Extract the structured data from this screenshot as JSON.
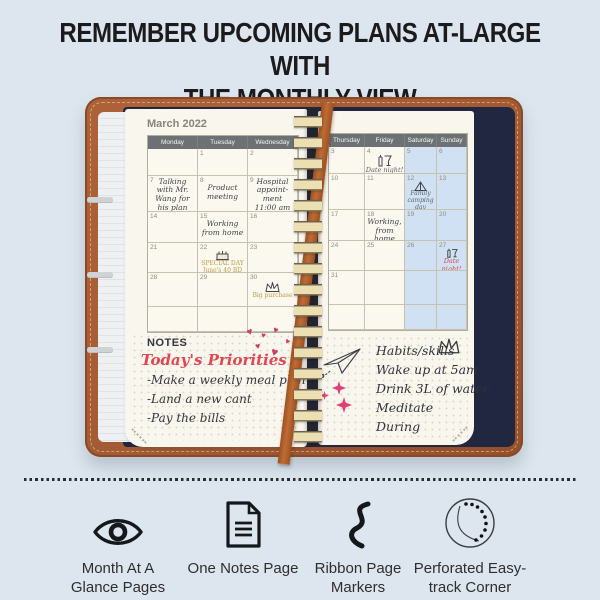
{
  "colors": {
    "background": "#dde6ee",
    "cover_brown": "#a25a33",
    "ribbon_brown": "#b2602c",
    "page_cream": "#f9f6ee",
    "day_header_gray": "#6e7174",
    "weekend_blue": "#cfe1f2",
    "accent_red": "#d8444d",
    "accent_mustard": "#c09a3e",
    "handwriting": "#3d4147",
    "pocket_navy": "#222741",
    "spiral_cream": "#ece0b2"
  },
  "heading": {
    "line1": "REMEMBER UPCOMING PLANS AT-LARGE WITH",
    "line2": "THE MONTHLY VIEW"
  },
  "notebook": {
    "month_title": "March 2022",
    "left_page": {
      "day_headers": [
        "Monday",
        "Tuesday",
        "Wednesday"
      ],
      "rows": [
        {
          "cells": [
            {
              "num": ""
            },
            {
              "num": "1"
            },
            {
              "num": "2"
            }
          ]
        },
        {
          "cells": [
            {
              "num": "7",
              "note": "Talking\nwith Mr.\nWang for\nhis plan"
            },
            {
              "num": "8",
              "note": "Product\nmeeting"
            },
            {
              "num": "9",
              "note": "Hospital\nappoint-\nment\n11:00 am"
            }
          ]
        },
        {
          "cells": [
            {
              "num": "14"
            },
            {
              "num": "15",
              "note": "Working\nfrom home"
            },
            {
              "num": "16"
            }
          ]
        },
        {
          "cells": [
            {
              "num": "21"
            },
            {
              "num": "22",
              "icon": "birthday-cake-icon",
              "note": "SPECIAL DAY\nJune's 40 BD"
            },
            {
              "num": "23"
            }
          ]
        },
        {
          "cells": [
            {
              "num": "28"
            },
            {
              "num": "29"
            },
            {
              "num": "30",
              "icon": "crown-icon",
              "note": "Big purchase"
            }
          ]
        }
      ],
      "notes_label": "NOTES",
      "notes": {
        "title": "Today's Priorities",
        "items": [
          "-Make a weekly meal plan",
          "-Land a new cant",
          "-Pay the bills"
        ]
      }
    },
    "right_page": {
      "day_headers": [
        "Thursday",
        "Friday",
        "Saturday",
        "Sunday"
      ],
      "rows": [
        {
          "cells": [
            {
              "num": "3"
            },
            {
              "num": "4",
              "icon": "drinks-icon",
              "note": "Date night!"
            },
            {
              "num": "5"
            },
            {
              "num": "6"
            }
          ]
        },
        {
          "cells": [
            {
              "num": "10"
            },
            {
              "num": "11"
            },
            {
              "num": "12",
              "icon": "tent-icon",
              "note": "Family\ncamping\nday"
            },
            {
              "num": "13"
            }
          ]
        },
        {
          "cells": [
            {
              "num": "17"
            },
            {
              "num": "18",
              "note": "Working,\nfrom home"
            },
            {
              "num": "19"
            },
            {
              "num": "20"
            }
          ]
        },
        {
          "cells": [
            {
              "num": "24"
            },
            {
              "num": "25"
            },
            {
              "num": "26"
            },
            {
              "num": "27",
              "icon": "drinks-icon",
              "note": "Date\nnight!"
            }
          ]
        },
        {
          "cells": [
            {
              "num": "31"
            },
            {
              "num": ""
            },
            {
              "num": ""
            },
            {
              "num": ""
            }
          ]
        }
      ],
      "habits": [
        "Habits/skills",
        "Wake up at 5am",
        "Drink 3L of water",
        "Meditate",
        "During"
      ]
    }
  },
  "features": [
    {
      "icon": "eye-icon",
      "label": "Month At A Glance Pages"
    },
    {
      "icon": "notes-page-icon",
      "label": "One Notes Page"
    },
    {
      "icon": "ribbon-icon",
      "label": "Ribbon Page Markers"
    },
    {
      "icon": "perforated-corner-icon",
      "label": "Perforated Easy-track Corner"
    }
  ]
}
